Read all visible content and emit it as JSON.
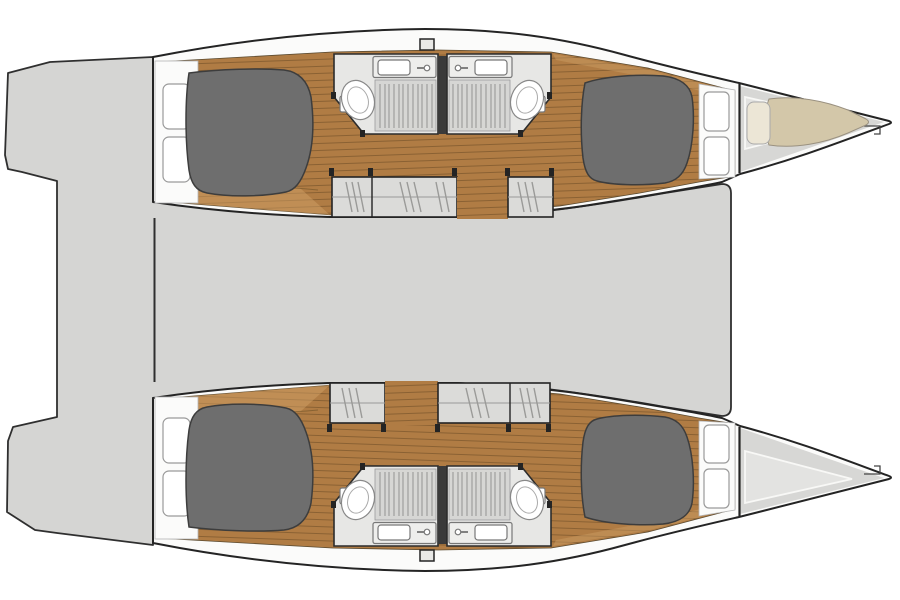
{
  "figure": {
    "kind": "boat-floor-plan",
    "subject": "catamaran interior deck layout, top-down view",
    "orientation": "bow-right, twin hulls top and bottom, stepped swim platforms at stern (left)"
  },
  "palette": {
    "background": "#ffffff",
    "deck": "#d5d5d3",
    "hull": "#fbfbfa",
    "wood": "#b07c44",
    "woodLine": "#8a6133",
    "woodLight": "#cfa066",
    "bathroomFloor": "#e7e7e5",
    "grateBase": "#d6d6d4",
    "steps": "#dbdbd9",
    "bed": "#6e6e6e",
    "mattress": "#d3c7a9",
    "pillow": "#ece6d6",
    "bowDeck": "#d7d7d5",
    "bowLiner": "#e3e3e1",
    "wall": "#3a3a3a",
    "outline": "#242424"
  },
  "components": {
    "hulls": [
      "hull-top",
      "hull-bottom"
    ],
    "per_hull": [
      "aft-double-cabin-bed",
      "side-locker-shelves",
      "two-wet-rooms-shower-toilet-sink",
      "companionway-steps",
      "forward-double-cabin-bed",
      "bow-peak"
    ],
    "center": [
      "bridgedeck-saloon-area",
      "cockpit",
      "stepped-transom-platforms"
    ],
    "bow_extras": [
      "forepeak-berth-mattress",
      "forepeak-pillow",
      "anchor-fitting",
      "deck-hatch"
    ],
    "counts": {
      "cabins": 4,
      "wet_rooms": 4,
      "companionways": 4,
      "beds": 5
    }
  }
}
